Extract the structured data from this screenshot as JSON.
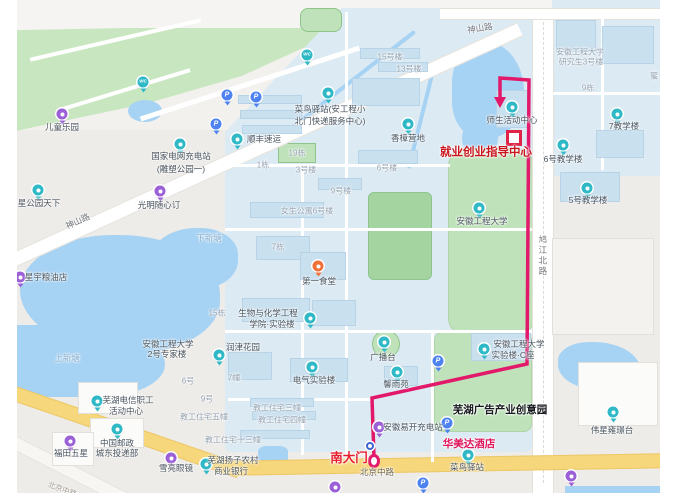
{
  "colors": {
    "route": "#e2186a",
    "park_green": "#c8e7c0",
    "campus_blue": "#dceaf3",
    "water_blue": "#a6d2f3",
    "road_yellow": "#f6d77c",
    "poi_teal": "#2fb8c5",
    "poi_purple": "#9b5fd6",
    "poi_parking": "#4d82f0",
    "dest_red": "#c9161d",
    "gate_red": "#e71e2e",
    "hotel_pink": "#e0175c"
  },
  "map": {
    "route": {
      "color": "#e2186a",
      "points": [
        [
          374,
          458
        ],
        [
          372,
          398
        ],
        [
          527,
          364
        ],
        [
          529,
          80
        ],
        [
          500,
          78
        ],
        [
          500,
          98
        ]
      ],
      "arrow_tip": [
        500,
        108
      ],
      "dest_square": [
        514,
        138
      ],
      "origin_marker": [
        374,
        461
      ],
      "origin_label": "南大门",
      "destination_label": "就业创业指导中心"
    },
    "labels": [
      {
        "t": "神山路",
        "x": 78,
        "y": 222,
        "c": "c-road",
        "r": -25
      },
      {
        "t": "神山路",
        "x": 480,
        "y": 29,
        "c": "c-road",
        "r": -9
      },
      {
        "t": "鸠江北路",
        "x": 542,
        "y": 256,
        "c": "c-roadv"
      },
      {
        "t": "北京中路",
        "x": 377,
        "y": 473,
        "c": "c-onroad"
      },
      {
        "t": "北京中路",
        "x": 62,
        "y": 490,
        "c": "c-faint",
        "r": 20
      },
      {
        "t": "下新塘",
        "x": 209,
        "y": 239,
        "c": "c-water"
      },
      {
        "t": "上新塘",
        "x": 67,
        "y": 359,
        "c": "c-water"
      },
      {
        "t": "15号楼",
        "x": 390,
        "y": 57,
        "c": "c-bldg"
      },
      {
        "t": "13号楼",
        "x": 409,
        "y": 69,
        "c": "c-bldg"
      },
      {
        "t": "9栋",
        "x": 588,
        "y": 88,
        "c": "c-bldg"
      },
      {
        "t": "蜜",
        "x": 654,
        "y": 76,
        "c": "c-bldg"
      },
      {
        "t": "安徽工程大学",
        "x": 580,
        "y": 52,
        "c": "c-bldg"
      },
      {
        "t": "研究生3号楼",
        "x": 581,
        "y": 62,
        "c": "c-bldg"
      },
      {
        "t": "19栋",
        "x": 297,
        "y": 153,
        "c": "c-bldg"
      },
      {
        "t": "1栋",
        "x": 263,
        "y": 165,
        "c": "c-bldg"
      },
      {
        "t": "3号楼",
        "x": 306,
        "y": 170,
        "c": "c-bldg"
      },
      {
        "t": "6号楼",
        "x": 387,
        "y": 168,
        "c": "c-bldg"
      },
      {
        "t": "9号楼",
        "x": 341,
        "y": 191,
        "c": "c-bldg"
      },
      {
        "t": "女生公寓6号楼",
        "x": 307,
        "y": 211,
        "c": "c-bldg"
      },
      {
        "t": "7栋",
        "x": 278,
        "y": 247,
        "c": "c-bldg"
      },
      {
        "t": "15栋",
        "x": 217,
        "y": 313,
        "c": "c-bldg"
      },
      {
        "t": "7幢",
        "x": 234,
        "y": 378,
        "c": "c-bldg"
      },
      {
        "t": "6号",
        "x": 188,
        "y": 381,
        "c": "c-bldg"
      },
      {
        "t": "9号",
        "x": 207,
        "y": 399,
        "c": "c-bldg"
      },
      {
        "t": "教工住宅五幢",
        "x": 204,
        "y": 417,
        "c": "c-bldg"
      },
      {
        "t": "教工住宅三幢",
        "x": 277,
        "y": 408,
        "c": "c-bldg"
      },
      {
        "t": "教工住宅四幢",
        "x": 282,
        "y": 420,
        "c": "c-bldg"
      },
      {
        "t": "教工住宅十三幢",
        "x": 233,
        "y": 440,
        "c": "c-bldg"
      },
      {
        "t": "儿童乐园",
        "x": 62,
        "y": 128,
        "c": ""
      },
      {
        "t": "国家电网充电站",
        "x": 181,
        "y": 157,
        "c": ""
      },
      {
        "t": "(雕塑公园一)",
        "x": 181,
        "y": 170,
        "c": ""
      },
      {
        "t": "顺丰速运",
        "x": 264,
        "y": 140,
        "c": ""
      },
      {
        "t": "菜鸟驿站(安工程小",
        "x": 330,
        "y": 110,
        "c": ""
      },
      {
        "t": "北门快递服务中心)",
        "x": 330,
        "y": 122,
        "c": ""
      },
      {
        "t": "香樟营地",
        "x": 408,
        "y": 139,
        "c": ""
      },
      {
        "t": "师生活动中心",
        "x": 512,
        "y": 121,
        "c": ""
      },
      {
        "t": "7教学楼",
        "x": 624,
        "y": 127,
        "c": ""
      },
      {
        "t": "6号教学楼",
        "x": 563,
        "y": 160,
        "c": ""
      },
      {
        "t": "5号教学楼",
        "x": 588,
        "y": 201,
        "c": ""
      },
      {
        "t": "安徽工程大学",
        "x": 482,
        "y": 222,
        "c": ""
      },
      {
        "t": "光明随心订",
        "x": 159,
        "y": 206,
        "c": ""
      },
      {
        "t": "星公园天下",
        "x": 39,
        "y": 204,
        "c": ""
      },
      {
        "t": "星宇粮油店",
        "x": 46,
        "y": 278,
        "c": ""
      },
      {
        "t": "第一食堂",
        "x": 319,
        "y": 282,
        "c": ""
      },
      {
        "t": "生物与化学工程",
        "x": 268,
        "y": 314,
        "c": ""
      },
      {
        "t": "学院·实验楼",
        "x": 272,
        "y": 325,
        "c": ""
      },
      {
        "t": "安徽工程大学",
        "x": 168,
        "y": 345,
        "c": ""
      },
      {
        "t": "2号专家楼",
        "x": 167,
        "y": 355,
        "c": ""
      },
      {
        "t": "润津花园",
        "x": 243,
        "y": 348,
        "c": ""
      },
      {
        "t": "电气实验楼",
        "x": 314,
        "y": 381,
        "c": ""
      },
      {
        "t": "广播台",
        "x": 383,
        "y": 358,
        "c": ""
      },
      {
        "t": "馨雨苑",
        "x": 396,
        "y": 385,
        "c": ""
      },
      {
        "t": "芜湖电信职工",
        "x": 128,
        "y": 401,
        "c": ""
      },
      {
        "t": "活动中心",
        "x": 126,
        "y": 412,
        "c": ""
      },
      {
        "t": "中国邮政",
        "x": 117,
        "y": 444,
        "c": ""
      },
      {
        "t": "城东投递部",
        "x": 117,
        "y": 454,
        "c": ""
      },
      {
        "t": "福田五星",
        "x": 71,
        "y": 454,
        "c": ""
      },
      {
        "t": "雪亮眼镜",
        "x": 176,
        "y": 469,
        "c": ""
      },
      {
        "t": "芜湖扬子农村",
        "x": 233,
        "y": 461,
        "c": ""
      },
      {
        "t": "商业银行",
        "x": 231,
        "y": 472,
        "c": ""
      },
      {
        "t": "安徽易开充电站",
        "x": 413,
        "y": 428,
        "c": ""
      },
      {
        "t": "菜鸟驿站",
        "x": 467,
        "y": 468,
        "c": ""
      },
      {
        "t": "伟星雍璟台",
        "x": 612,
        "y": 431,
        "c": ""
      },
      {
        "t": "安徽工程大学",
        "x": 519,
        "y": 345,
        "c": ""
      },
      {
        "t": "实验楼·C座",
        "x": 513,
        "y": 356,
        "c": ""
      },
      {
        "t": "就业创业指导中心",
        "x": 486,
        "y": 153,
        "c": "c-dest"
      },
      {
        "t": "南大门",
        "x": 349,
        "y": 458,
        "c": "c-gate"
      },
      {
        "t": "华美达酒店",
        "x": 469,
        "y": 444,
        "c": "c-pink"
      },
      {
        "t": "芜湖广告产业创意园",
        "x": 500,
        "y": 410,
        "c": "c-black"
      }
    ],
    "pois": [
      {
        "k": "purple",
        "x": 62,
        "y": 114,
        "n": "儿童乐园"
      },
      {
        "k": "wc",
        "x": 143,
        "y": 82,
        "n": "卫生间",
        "g": "WC"
      },
      {
        "k": "wc",
        "x": 307,
        "y": 55,
        "n": "卫生间",
        "g": "WC"
      },
      {
        "k": "parking",
        "x": 216,
        "y": 124,
        "n": "停车场",
        "g": "P"
      },
      {
        "k": "parking",
        "x": 227,
        "y": 95,
        "n": "停车场",
        "g": "P"
      },
      {
        "k": "parking",
        "x": 256,
        "y": 97,
        "n": "停车场",
        "g": "P"
      },
      {
        "k": "teal",
        "x": 180,
        "y": 144,
        "n": "国家电网充电站"
      },
      {
        "k": "teal",
        "x": 237,
        "y": 139,
        "n": "顺丰速运"
      },
      {
        "k": "teal",
        "x": 328,
        "y": 93,
        "n": "菜鸟驿站(安工程小北门快递服务中心)"
      },
      {
        "k": "teal",
        "x": 408,
        "y": 124,
        "n": "香樟营地"
      },
      {
        "k": "teal",
        "x": 512,
        "y": 107,
        "n": "师生活动中心"
      },
      {
        "k": "teal",
        "x": 617,
        "y": 114,
        "n": "7教学楼"
      },
      {
        "k": "teal",
        "x": 563,
        "y": 145,
        "n": "6号教学楼"
      },
      {
        "k": "teal",
        "x": 587,
        "y": 188,
        "n": "5号教学楼"
      },
      {
        "k": "teal",
        "x": 479,
        "y": 208,
        "n": "安徽工程大学"
      },
      {
        "k": "purple",
        "x": 160,
        "y": 191,
        "n": "光明随心订"
      },
      {
        "k": "teal",
        "x": 38,
        "y": 190,
        "n": "星公园天下"
      },
      {
        "k": "purple",
        "x": 20,
        "y": 277,
        "n": "星宇粮油店"
      },
      {
        "k": "food",
        "x": 318,
        "y": 266,
        "n": "第一食堂"
      },
      {
        "k": "teal",
        "x": 310,
        "y": 318,
        "n": "生物与化学工程学院实验楼"
      },
      {
        "k": "teal",
        "x": 219,
        "y": 355,
        "n": "安徽工程大学2号专家楼"
      },
      {
        "k": "teal",
        "x": 312,
        "y": 367,
        "n": "电气实验楼"
      },
      {
        "k": "teal",
        "x": 384,
        "y": 342,
        "n": "广播台"
      },
      {
        "k": "teal",
        "x": 397,
        "y": 372,
        "n": "馨雨苑"
      },
      {
        "k": "parking",
        "x": 438,
        "y": 361,
        "n": "停车场",
        "g": "P"
      },
      {
        "k": "teal",
        "x": 97,
        "y": 401,
        "n": "芜湖电信职工活动中心"
      },
      {
        "k": "teal",
        "x": 117,
        "y": 429,
        "n": "中国邮政城东投递部"
      },
      {
        "k": "purple",
        "x": 70,
        "y": 441,
        "n": "福田五星"
      },
      {
        "k": "purple",
        "x": 171,
        "y": 458,
        "n": "雪亮眼镜"
      },
      {
        "k": "teal",
        "x": 206,
        "y": 464,
        "n": "芜湖扬子农村商业银行"
      },
      {
        "k": "purple",
        "x": 379,
        "y": 427,
        "n": "安徽易开充电站"
      },
      {
        "k": "parking",
        "x": 447,
        "y": 423,
        "n": "停车场",
        "g": "P"
      },
      {
        "k": "parking",
        "x": 423,
        "y": 483,
        "n": "停车场",
        "g": "P"
      },
      {
        "k": "gate",
        "x": 370,
        "y": 446,
        "n": "南大门"
      },
      {
        "k": "teal",
        "x": 468,
        "y": 455,
        "n": "菜鸟驿站"
      },
      {
        "k": "teal",
        "x": 484,
        "y": 349,
        "n": "安徽工程大学实验楼C座"
      },
      {
        "k": "teal",
        "x": 613,
        "y": 412,
        "n": "伟星雍璟台"
      },
      {
        "k": "purple",
        "x": 335,
        "y": 487,
        "n": "POI"
      },
      {
        "k": "purple",
        "x": 571,
        "y": 476,
        "n": "POI"
      }
    ]
  }
}
